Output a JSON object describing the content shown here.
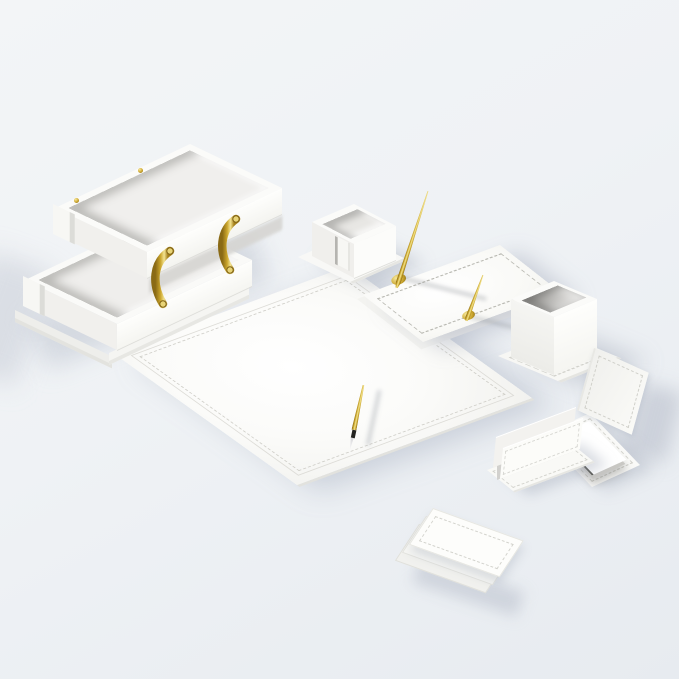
{
  "meta": {
    "description": "Product photograph of a white leather executive desk organizer set with gold metal accents on a pale blue-grey studio background",
    "visible_text": ""
  },
  "palette": {
    "background": "#eef1f5",
    "leather_white": "#fbfbf9",
    "leather_shaded": "#f1f0ed",
    "interior_shadow": "#d6d5d2",
    "cup_interior": "#bebdba",
    "stitch_line": "#cfcec8",
    "gold": "#c9a42b",
    "gold_highlight": "#f4e58e",
    "gold_dark": "#7e6115",
    "pen_grip_black": "#23231f",
    "pen_tip_silver": "#e9e9eb",
    "cast_shadow": "rgba(150,158,178,0.40)"
  },
  "items": {
    "desk_pad": {
      "label": "white leather desk pad blotter with double stitched border"
    },
    "blotter_pen": {
      "label": "gold ballpoint pen lying on desk pad"
    },
    "upper_tray": {
      "label": "upper letter tray of two-tier document tray"
    },
    "lower_tray": {
      "label": "lower letter tray of two-tier document tray"
    },
    "tray_base": {
      "label": "base plinth under document trays"
    },
    "handle_left": {
      "label": "curved gold riser handle, left"
    },
    "handle_right": {
      "label": "curved gold riser handle, right"
    },
    "screws": {
      "label": "gold screws on tray rim"
    },
    "memo_box": {
      "label": "memo paper holder box on base plate"
    },
    "pen_stand": {
      "label": "double pen stand base with stitched border"
    },
    "pen_tall": {
      "label": "tall gold desk pen in stand"
    },
    "pen_short": {
      "label": "short gold desk pen in stand"
    },
    "pencil_cup": {
      "label": "square pencil cup on base plate"
    },
    "note_holder": {
      "label": "note pad holder with angled backrest and paper stack"
    },
    "letter_holder": {
      "label": "upright letter and envelope holder"
    },
    "coasters": {
      "label": "fanned stack of three square leather coasters"
    }
  }
}
